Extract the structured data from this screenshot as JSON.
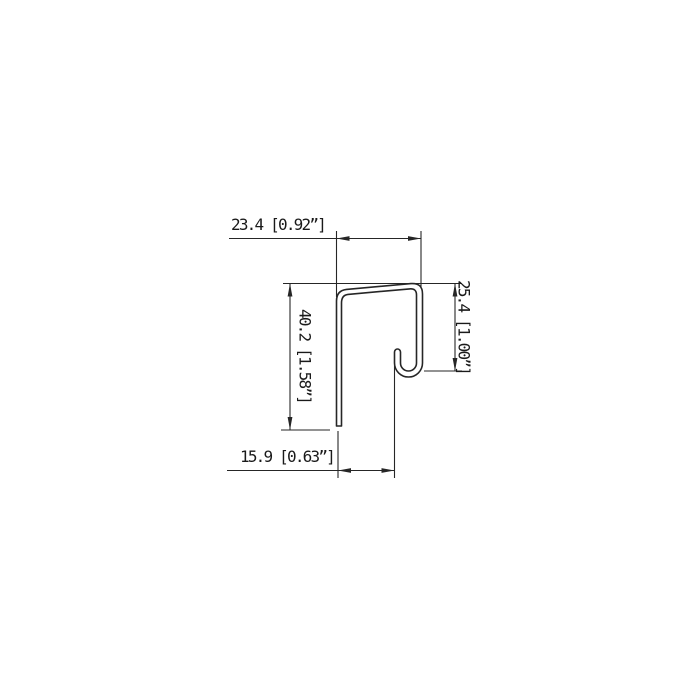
{
  "drawing": {
    "kind": "technical-cross-section",
    "subject": "sheet-metal J-hook trim profile",
    "background_color": "#ffffff",
    "line_color": "#262626",
    "text_color": "#1a1a1a",
    "dimensions": {
      "top_width": {
        "label": "23.4 [0.92”]",
        "mm": "23.4",
        "inch": "0.92”"
      },
      "right_height": {
        "label": "25.4 [1.00”]",
        "mm": "25.4",
        "inch": "1.00”"
      },
      "left_height": {
        "label": "40.2 [1.58”]",
        "mm": "40.2",
        "inch": "1.58”"
      },
      "bottom_width": {
        "label": "15.9 [0.63”]",
        "mm": "15.9",
        "inch": "0.63”"
      }
    }
  }
}
